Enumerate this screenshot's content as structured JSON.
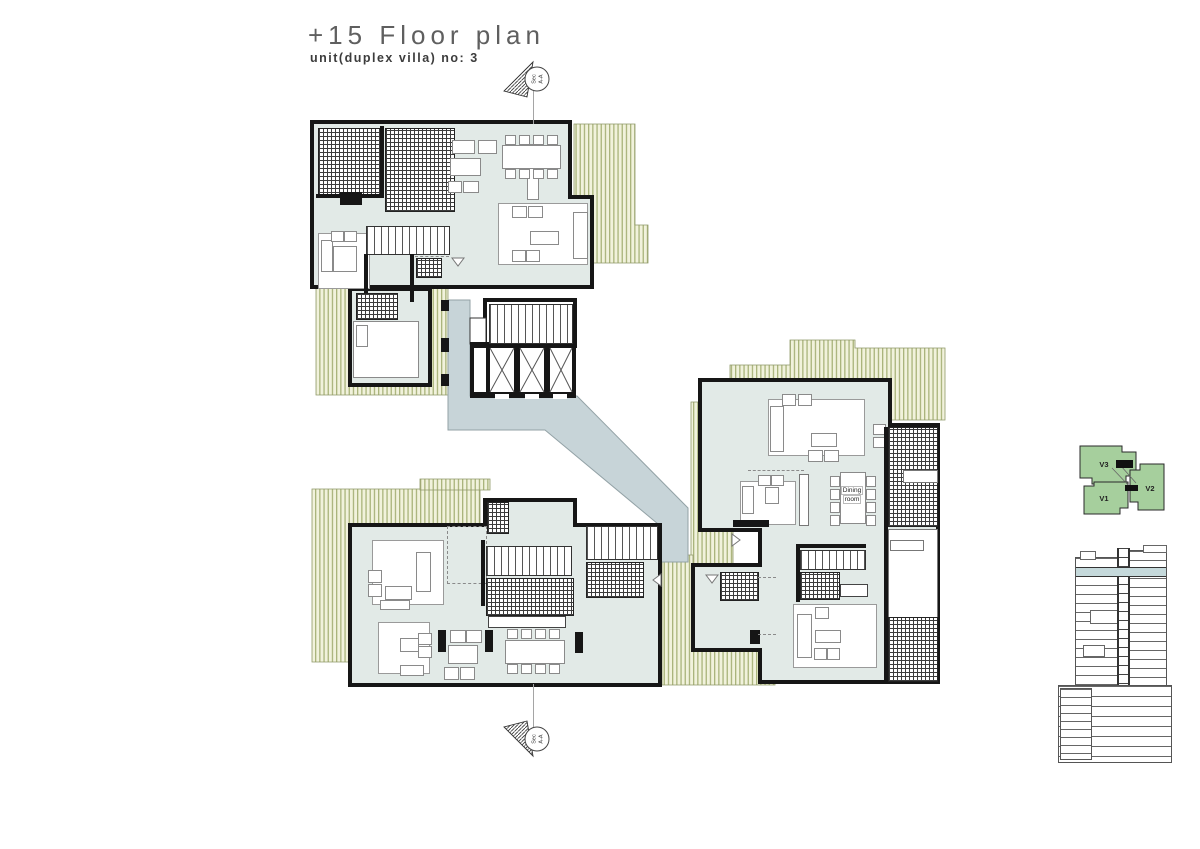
{
  "header": {
    "title": "+15 Floor plan",
    "subtitle": "unit(duplex villa) no: 3"
  },
  "section_marker": {
    "line1": "Sec",
    "line2": "A-A"
  },
  "plan": {
    "dining_label": {
      "line1": "Dining",
      "line2": "room"
    }
  },
  "key_plan": {
    "v1": "V1",
    "v2": "V2",
    "v3": "V3"
  },
  "icons": {
    "section_cut_marker": "circle-with-hatched-triangle",
    "door_swing_marker": "open-triangle",
    "elevator_cross": "x-cross",
    "stair_treads": "striped-band",
    "terrace_hatch": "vertical-green-stripes",
    "void_hatch": "cross-grid"
  },
  "colors": {
    "room_fill": "#e2eae7",
    "corridor_fill": "#c7d4d8",
    "balcony_bg": "#f1f2dc",
    "balcony_stripe": "#a9b37b",
    "wall": "#161616",
    "hatch_line": "#3c3c3c",
    "stair_line": "#555555",
    "furniture_line": "#8a8a8a",
    "key_plan_green": "#a6cf9d",
    "section_highlight": "#c5d9db",
    "drawing_line": "#9a9a9a",
    "title_color": "#5f5f5f",
    "subtitle_color": "#3c3c3c"
  }
}
